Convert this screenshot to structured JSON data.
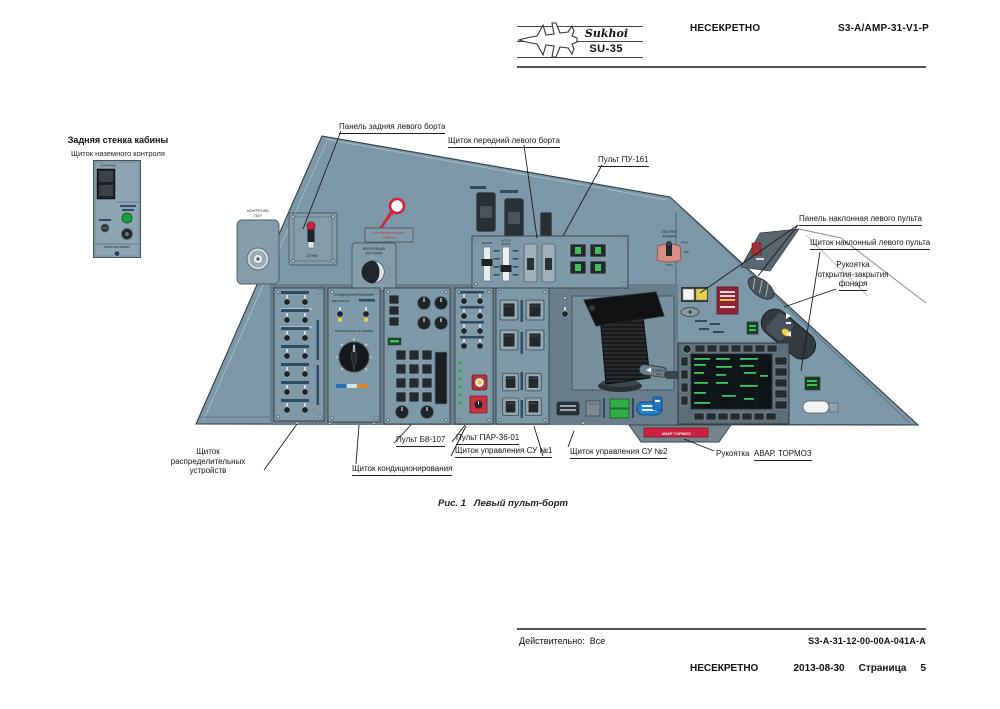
{
  "header": {
    "brand": "Sukhoi",
    "model": "SU-35",
    "classification": "НЕСЕКРЕТНО",
    "doc_code": "S3-A/AMP-31-V1-P"
  },
  "rear_wall": {
    "title": "Задняя стенка кабины",
    "subtitle": "Щиток наземного контроля",
    "label_top": "КОНТРОЛЬ",
    "label_bottom": "КОНТРОЛЬ ПРИБОР"
  },
  "callouts": {
    "panel_rear": "Панель задняя левого борта",
    "shield_front": "Щиток передний левого борта",
    "pu161": "Пульт ПУ-161",
    "panel_inclined": "Панель наклонная левого пульта",
    "shield_inclined": "Щиток наклонный левого пульта",
    "canopy_handle": [
      "Рукоятка",
      "открытия-закрытия",
      "фонаря"
    ],
    "shield_distrib": [
      "Щиток",
      "распределительных",
      "устройств"
    ],
    "shield_cond": "Щиток кондиционирования",
    "pult_b8": "Пульт Б8-107",
    "pult_par": "Пульт ПАР-36-01",
    "su1": "Щиток управления СУ №1",
    "su2": "Щиток управления СУ №2",
    "brake_prefix": "Рукоятка",
    "brake": "АВАР. ТОРМОЗ"
  },
  "console": {
    "kontrol_plu": [
      "КОНТРОЛЬ",
      "ПЛУ"
    ],
    "ogni": "ОГНИ",
    "razgerm": [
      "РАЗГЕРМЕТИЗАЦИЯ",
      "КАБИНЫ"
    ],
    "vent": [
      "ВЕНТИЛЯЦИЯ",
      "КОСТЮМА"
    ],
    "cond_title": "КОНДИЦИОНИРОВАНИЕ",
    "ventilator": "ВЕНТИЛЯТОР",
    "temp": "ТЕМПЕРАТУРА В КАБИНЕ",
    "obogrev": [
      "ОБОГРЕВ",
      "ФОНАРЯ"
    ],
    "obogrev_modes": [
      "РУЧН",
      "АВТ",
      "ОТКЛ"
    ],
    "rezhim": "РЕЖИМ",
    "nosok": [
      "НОСОК",
      "КРЫЛА"
    ],
    "tormoz_ruch": [
      "ТОРМОЗ",
      "РУЧ"
    ],
    "avar_tormoz": "АВАР  ТОРМОЗ"
  },
  "caption": {
    "figure": "Рис. 1",
    "title": "Левый пульт-борт"
  },
  "footer": {
    "effectivity_label": "Действительно:",
    "effectivity_value": "Все",
    "doc_code": "S3-A-31-12-00-00A-041A-A",
    "classification": "НЕСЕКРЕТНО",
    "date": "2013-08-30",
    "page_label": "Страница",
    "page_number": "5"
  },
  "colors": {
    "console": "#7d98a8",
    "panel_border": "#39464d",
    "red": "#d2203c",
    "dark_red": "#8e2638",
    "green": "#3fc05c",
    "yellow": "#e7d23a"
  }
}
